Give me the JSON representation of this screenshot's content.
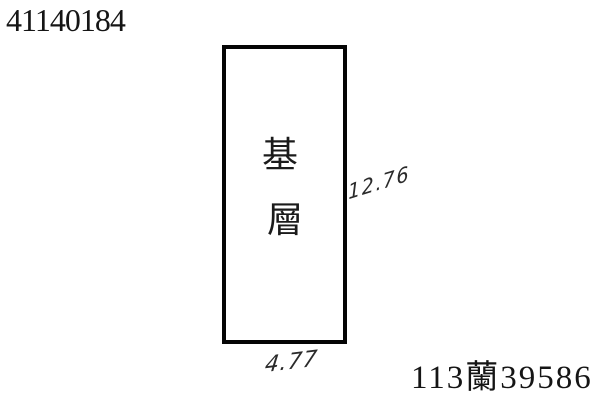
{
  "document": {
    "case_number": "41140184",
    "reference_number": "113蘭39586"
  },
  "drawing": {
    "building_label": "基層",
    "building_label_chars": [
      "基",
      "層"
    ],
    "dimensions": {
      "right_side": "12.76",
      "bottom_side": "4.77"
    }
  },
  "colors": {
    "paper": "#ffffff",
    "printed_ink": "#151515",
    "outline_ink": "#050505",
    "handwriting_ink": "#2a2a2a"
  }
}
